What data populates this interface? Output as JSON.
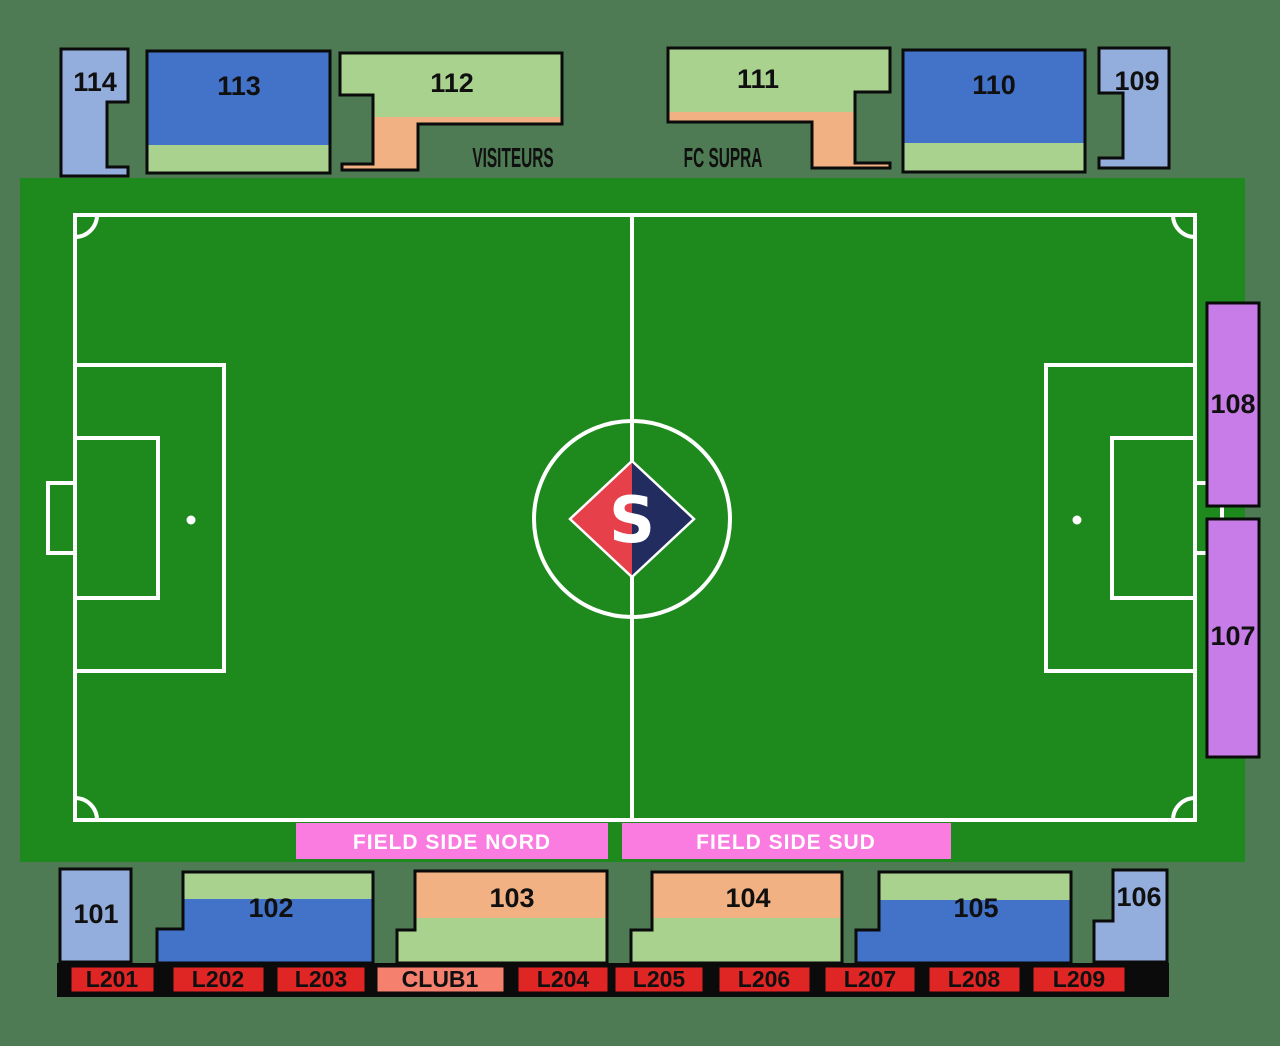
{
  "logo": {
    "letter": "S"
  },
  "annotations": {
    "visiteurs": "VISITEURS",
    "fc_supra": "FC SUPRA"
  },
  "stands": {
    "top": [
      {
        "label": "114"
      },
      {
        "label": "113"
      },
      {
        "label": "112"
      },
      {
        "label": "111"
      },
      {
        "label": "110"
      },
      {
        "label": "109"
      }
    ],
    "right": [
      {
        "label": "108"
      },
      {
        "label": "107"
      }
    ],
    "bottom": [
      {
        "label": "101"
      },
      {
        "label": "102"
      },
      {
        "label": "103"
      },
      {
        "label": "104"
      },
      {
        "label": "105"
      },
      {
        "label": "106"
      }
    ],
    "field_side": [
      {
        "label": "FIELD SIDE NORD"
      },
      {
        "label": "FIELD SIDE SUD"
      }
    ],
    "lounges": [
      {
        "label": "L201"
      },
      {
        "label": "L202"
      },
      {
        "label": "L203"
      },
      {
        "label": "CLUB1"
      },
      {
        "label": "L204"
      },
      {
        "label": "L205"
      },
      {
        "label": "L206"
      },
      {
        "label": "L207"
      },
      {
        "label": "L208"
      },
      {
        "label": "L209"
      }
    ]
  },
  "colors": {
    "background": "#4e7a54",
    "pitch": "#1e8a1e",
    "line": "#ffffff",
    "light_blue": "#93aedd",
    "blue": "#4273c8",
    "light_green": "#a9d28f",
    "orange": "#f2b183",
    "purple": "#c87ce8",
    "pink": "#fa7ce1",
    "red": "#e02525",
    "salmon": "#f5806e",
    "black_strip": "#0b0b0b",
    "logo_red": "#e6414b",
    "logo_navy": "#222c5e"
  }
}
